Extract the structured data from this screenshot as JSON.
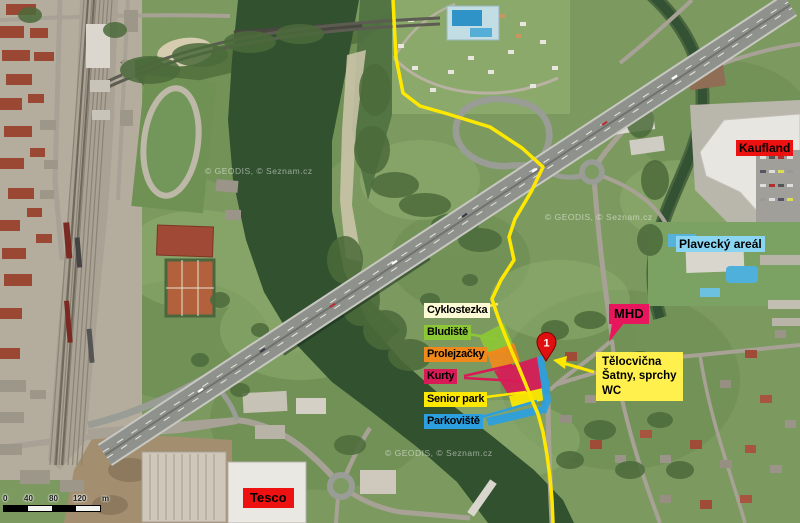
{
  "map": {
    "watermark": "© GEODIS, © Seznam.cz",
    "scale_bar": {
      "ticks": [
        "0",
        "40",
        "80",
        "120"
      ],
      "unit": "m"
    },
    "route_color": "#ffe800"
  },
  "legend": {
    "items": [
      {
        "label": "Cyklostezka",
        "color": "#fdfbd6"
      },
      {
        "label": "Bludiště",
        "color": "#8cc736"
      },
      {
        "label": "Prolejzačky",
        "color": "#f0891c"
      },
      {
        "label": "Kurty",
        "color": "#d81a57"
      },
      {
        "label": "Senior park",
        "color": "#ffe900"
      },
      {
        "label": "Parkoviště",
        "color": "#2b9fe0"
      }
    ]
  },
  "pois": {
    "kaufland": {
      "label": "Kaufland",
      "color": "#ee1111"
    },
    "plavecky": {
      "label": "Plavecký areál",
      "color": "#8ad6f2"
    },
    "mhd": {
      "label": "MHD",
      "color": "#e8175d"
    },
    "tesco": {
      "label": "Tesco",
      "color": "#ee1111"
    }
  },
  "callout": {
    "line1": "Tělocvična",
    "line2": "Šatny, sprchy",
    "line3": "WC",
    "color": "#fff04d"
  },
  "marker": {
    "number": "1",
    "color": "#e01010"
  }
}
